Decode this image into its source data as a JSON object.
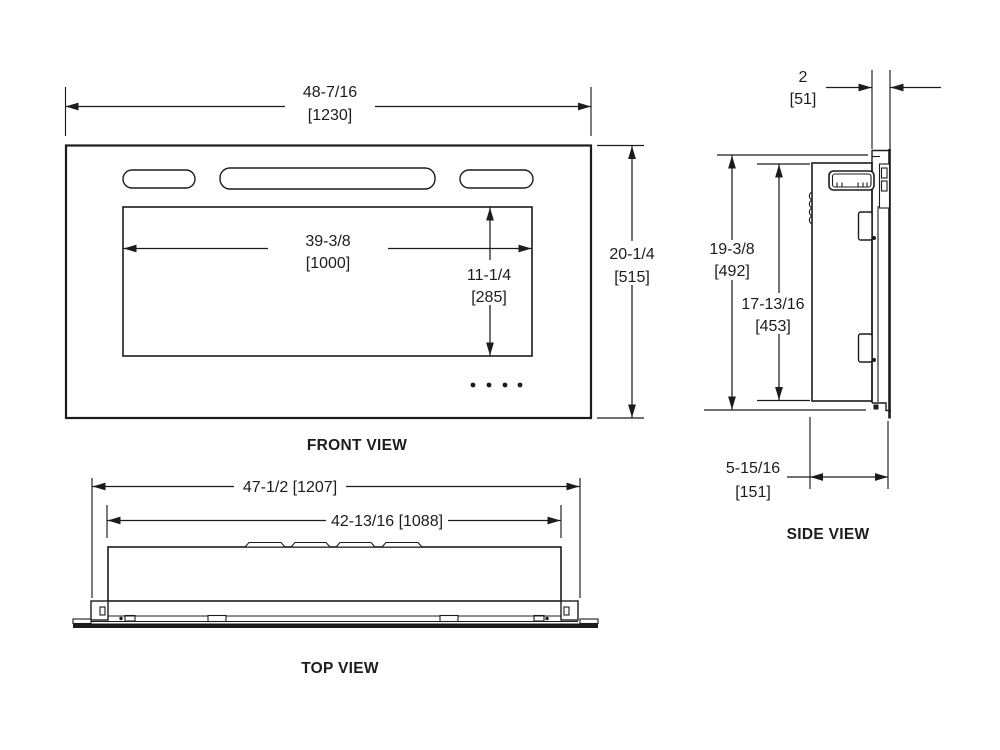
{
  "views": {
    "front": {
      "label": "FRONT VIEW",
      "overall_width_in": "48-7/16",
      "overall_width_mm": "[1230]",
      "overall_height_in": "20-1/4",
      "overall_height_mm": "[515]",
      "opening_width_in": "39-3/8",
      "opening_width_mm": "[1000]",
      "opening_height_in": "11-1/4",
      "opening_height_mm": "[285]"
    },
    "side": {
      "label": "SIDE VIEW",
      "protrusion_depth_in": "2",
      "protrusion_depth_mm": "[51]",
      "overall_height_in": "19-3/8",
      "overall_height_mm": "[492]",
      "body_height_in": "17-13/16",
      "body_height_mm": "[453]",
      "recess_depth_in": "5-15/16",
      "recess_depth_mm": "[151]"
    },
    "top": {
      "label": "TOP VIEW",
      "overall_width": "47-1/2 [1207]",
      "body_width": "42-13/16 [1088]"
    }
  },
  "style": {
    "line_color": "#1c1c1c",
    "background": "#ffffff"
  }
}
